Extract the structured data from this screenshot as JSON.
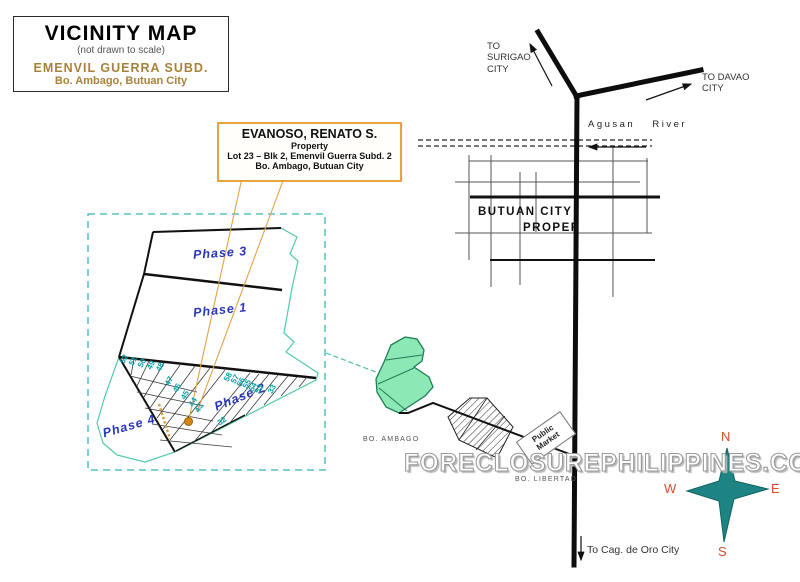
{
  "title_box": {
    "title": "VICINITY MAP",
    "subtitle": "(not drawn to scale)",
    "subdivision": "EMENVIL GUERRA SUBD.",
    "location": "Bo. Ambago, Butuan City"
  },
  "property_box": {
    "owner": "EVANOSO, RENATO S.",
    "label": "Property",
    "lot": "Lot 23 – Blk 2, Emenvil Guerra Subd. 2",
    "location": "Bo. Ambago, Butuan City"
  },
  "subdivision": {
    "phase_labels": [
      "Phase 3",
      "Phase 1",
      "Phase 2",
      "Phase 4"
    ],
    "lots": [
      "52",
      "51",
      "50",
      "49",
      "48",
      "47",
      "46",
      "45",
      "44",
      "43",
      "58",
      "57",
      "56",
      "55",
      "54",
      "53",
      "33",
      "32"
    ]
  },
  "city_map": {
    "to_surigao_l1": "TO",
    "to_surigao_l2": "SURIGAO",
    "to_surigao_l3": "CITY",
    "to_davao_l1": "TO DAVAO",
    "to_davao_l2": "CITY",
    "river": "Agusan River",
    "butuan_l1": "BUTUAN CITY",
    "butuan_l2": "PROPER",
    "public_market": "Public Market",
    "bo_ambago": "BO. AMBAGO",
    "bo_libertad": "BO. LIBERTAD",
    "to_cagayan": "To Cag. de Oro City"
  },
  "compass": {
    "n": "N",
    "s": "S",
    "e": "E",
    "w": "W"
  },
  "watermark": "FORECLOSUREPHILIPPINES.COM",
  "colors": {
    "accent_orange": "#e8a43c",
    "brown_heading": "#a8823c",
    "phase_blue": "#2a35b5",
    "lot_teal": "#00a0a5",
    "boundary_teal": "#54c8ac",
    "star_teal": "#1d8383",
    "compass_red": "#d04f2a",
    "mint_green": "#8ce8b4"
  }
}
